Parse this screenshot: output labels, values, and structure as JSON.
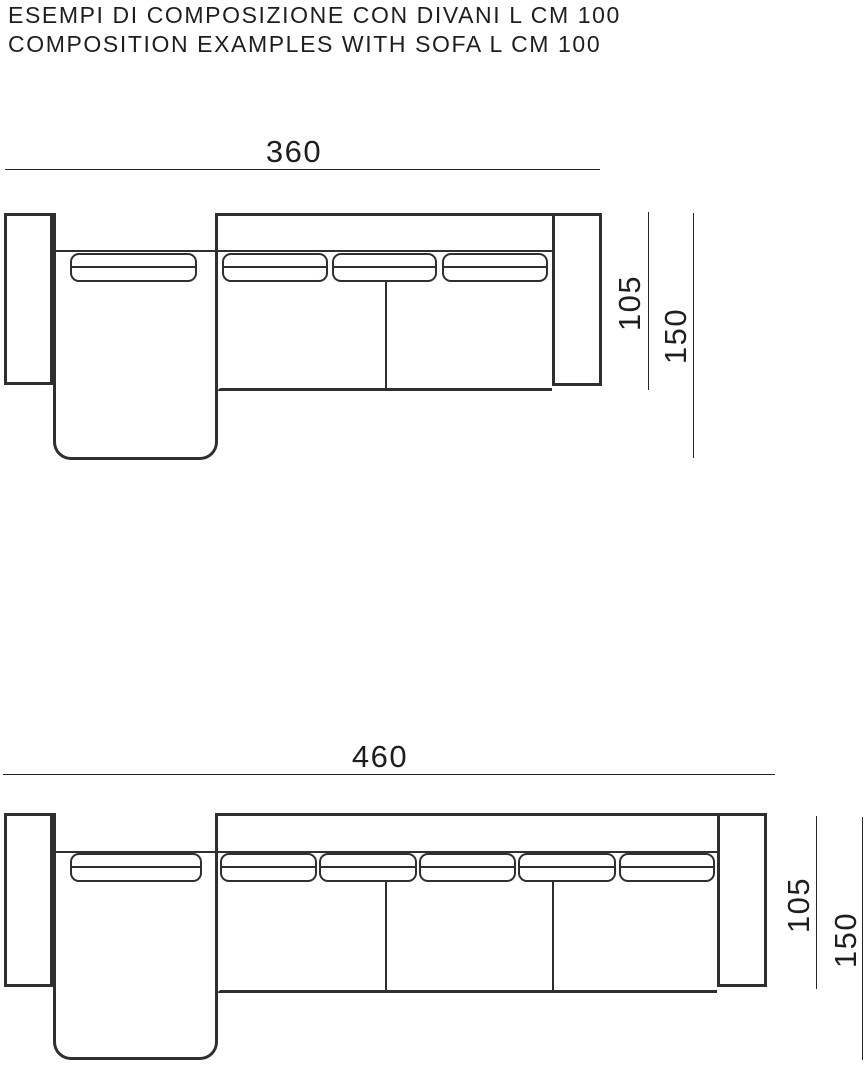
{
  "title": {
    "line1": "ESEMPI DI COMPOSIZIONE CON DIVANI L CM 100",
    "line2": "COMPOSITION EXAMPLES WITH SOFA L CM 100"
  },
  "colors": {
    "stroke": "#2d2f30",
    "text": "#1e1e1e",
    "background": "#ffffff"
  },
  "diagrams": [
    {
      "name": "composition-with-sofa-360",
      "width_cm": "360",
      "seat_depth_cm": "105",
      "chaise_depth_cm": "150"
    },
    {
      "name": "composition-with-sofa-460",
      "width_cm": "460",
      "seat_depth_cm": "105",
      "chaise_depth_cm": "150"
    }
  ]
}
